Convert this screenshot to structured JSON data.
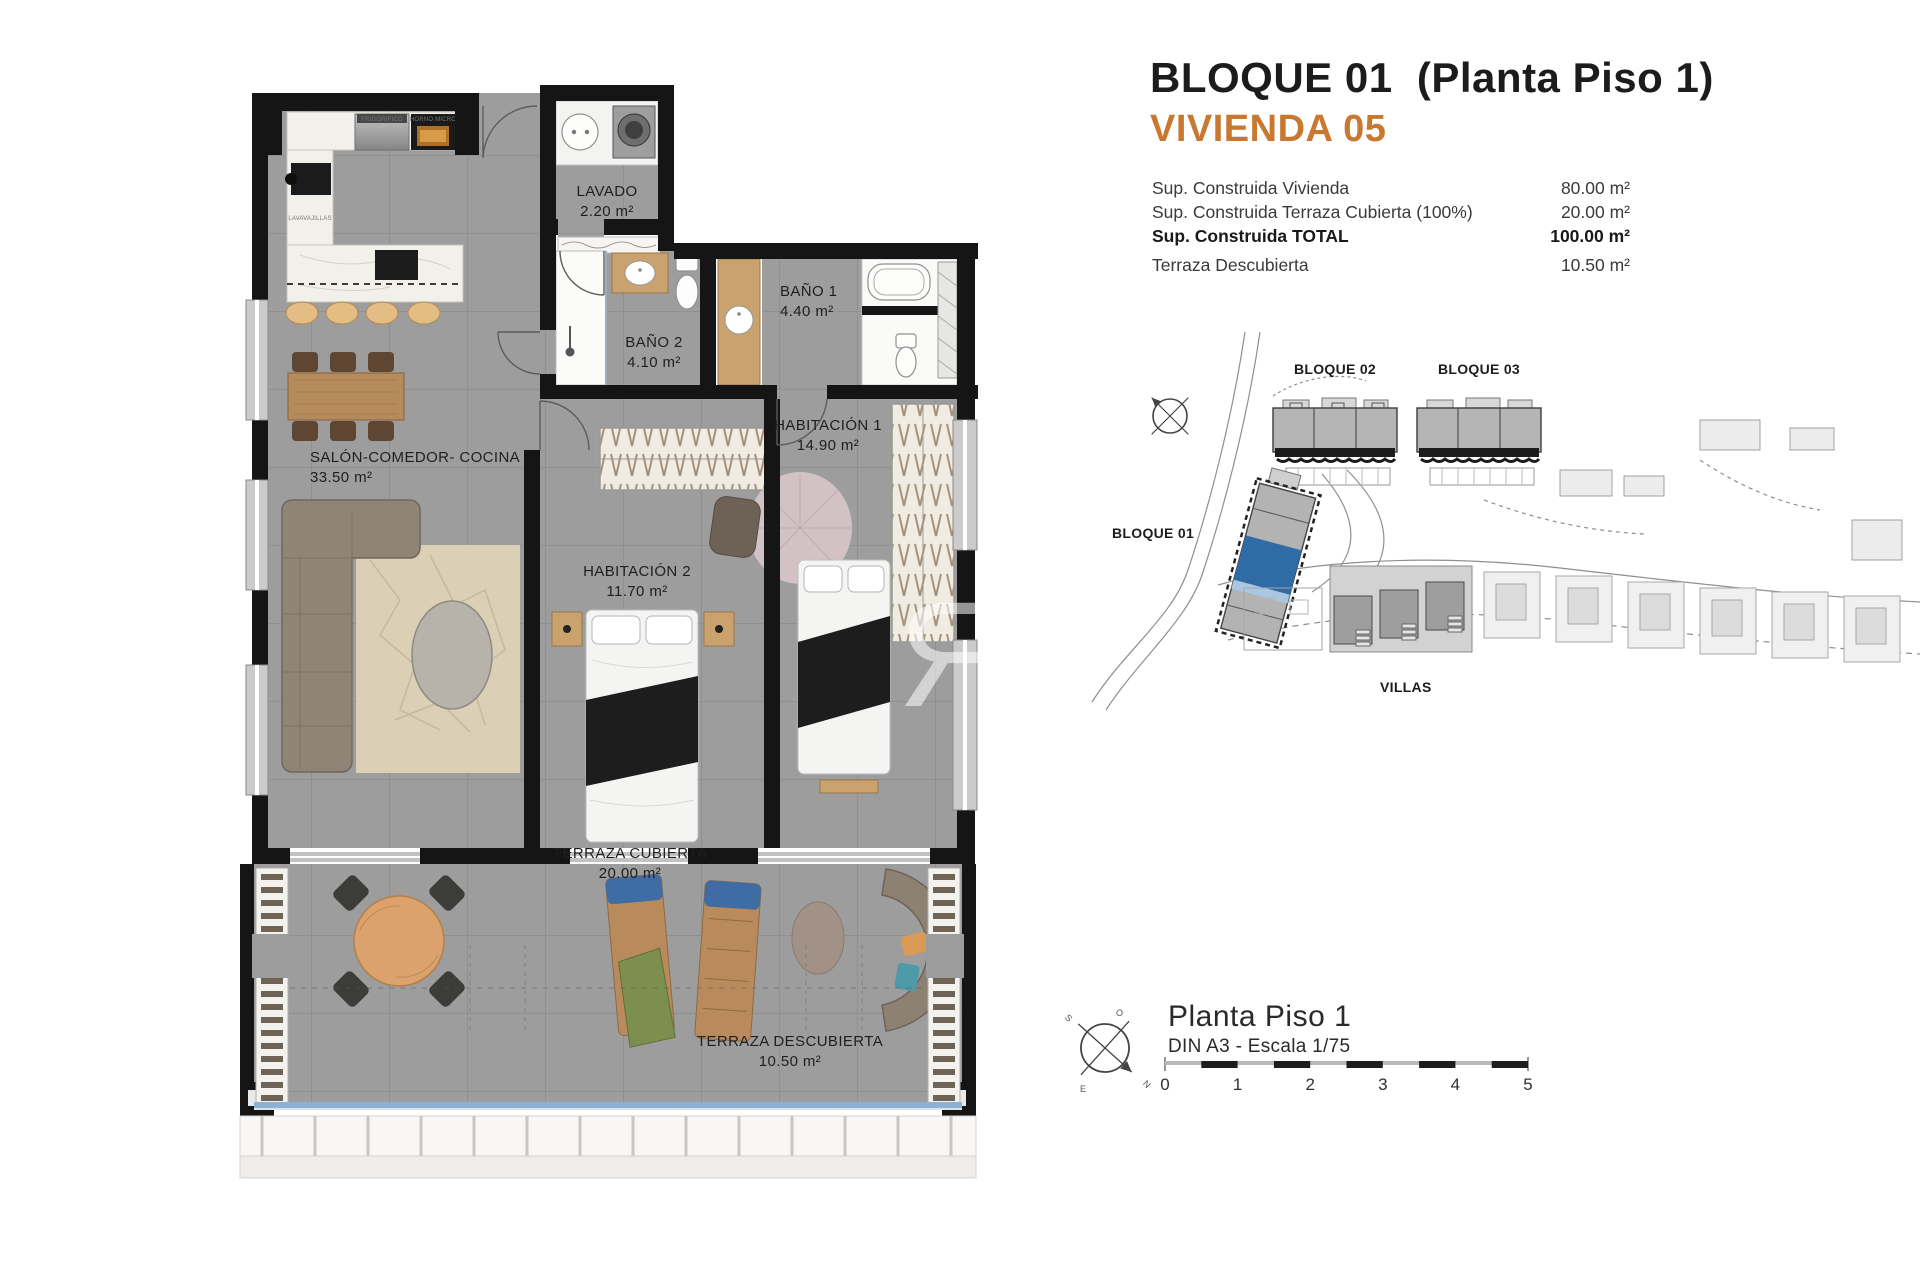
{
  "header": {
    "title": "BLOQUE 01  (Planta Piso 1)",
    "subtitle": "VIVIENDA 05",
    "accent_color": "#c8792f",
    "summary": {
      "rows": [
        {
          "label": "Sup. Construida Vivienda",
          "value": "80.00 m²",
          "bold": false
        },
        {
          "label": "Sup. Construida Terraza Cubierta (100%)",
          "value": "20.00 m²",
          "bold": false
        },
        {
          "label": "Sup. Construida TOTAL",
          "value": "100.00 m²",
          "bold": true
        },
        {
          "label": "Terraza Descubierta",
          "value": "10.50 m²",
          "bold": false
        }
      ]
    }
  },
  "floor_plan": {
    "rooms": [
      {
        "name": "LAVADO",
        "area": "2.20 m²"
      },
      {
        "name": "BAÑO 2",
        "area": "4.10 m²"
      },
      {
        "name": "BAÑO 1",
        "area": "4.40 m²"
      },
      {
        "name": "HABITACIÓN 1",
        "area": "14.90 m²"
      },
      {
        "name": "HABITACIÓN 2",
        "area": "11.70 m²"
      },
      {
        "name": "SALÓN-COMEDOR- COCINA",
        "area": "33.50 m²"
      },
      {
        "name": "TERRAZA CUBIERTA",
        "area": "20.00 m²"
      },
      {
        "name": "TERRAZA DESCUBIERTA",
        "area": "10.50 m²"
      }
    ],
    "appliance_labels": {
      "fridge": "FRIGORIFICO",
      "oven": "HORNO MICRO",
      "dishwasher": "LAVAVAJILLAS"
    },
    "watermark": "R"
  },
  "site_plan": {
    "labels": {
      "bloque01": "BLOQUE 01",
      "bloque02": "BLOQUE 02",
      "bloque03": "BLOQUE 03",
      "villas": "VILLAS"
    },
    "highlight_color": "#2f6ca6"
  },
  "footer": {
    "plan_title": "Planta Piso 1",
    "format_scale": "DIN A3 - Escala 1/75",
    "scale_ticks": [
      "0",
      "1",
      "2",
      "3",
      "4",
      "5"
    ],
    "compass_letters": {
      "n": "N",
      "s": "S",
      "e": "E",
      "o": "O"
    }
  }
}
